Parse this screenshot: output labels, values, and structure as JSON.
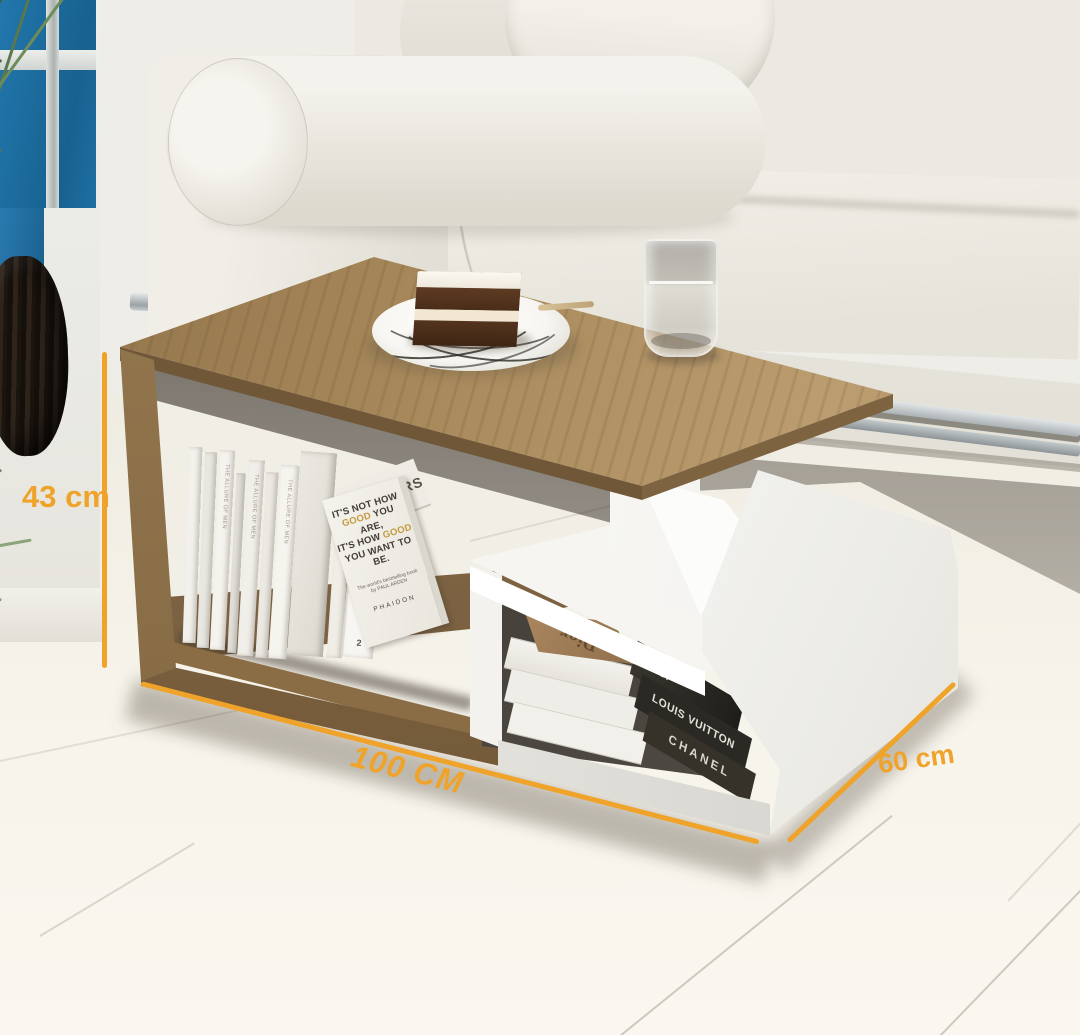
{
  "annotations": {
    "height": "43 cm",
    "width": "100 CM",
    "depth": "60 cm"
  },
  "books_left": {
    "spine_text": "THE ALLURE OF MEN",
    "interiors_cover_title": "INTERIORS",
    "interiors_spine_title": "INTERIORS",
    "interiors_spine_number": "2",
    "arden": {
      "l1": "IT'S NOT HOW",
      "l2_highlight": "GOOD",
      "l2_rest": "YOU ARE,",
      "l3_rest": "IT'S HOW",
      "l3_highlight": "GOOD",
      "l4": "YOU WANT TO BE.",
      "credit": "The world's bestselling book by PAUL ARDEN",
      "publisher": "PHAIDON"
    }
  },
  "books_right": {
    "top_cover": "Dior",
    "spines": [
      "Dior",
      "LOUIS VUITTON",
      "CHANEL"
    ]
  },
  "palette": {
    "accent": "#F0A32A",
    "wood": "#A8895C",
    "white_panel": "#FAF9F5",
    "sofa": "#ECEAE3",
    "floor": "#F3F0E7",
    "window_blue": "#1F6FA3",
    "vase": "#231C15",
    "plant": "#4C6B3E",
    "cake_brown": "#54341D"
  }
}
